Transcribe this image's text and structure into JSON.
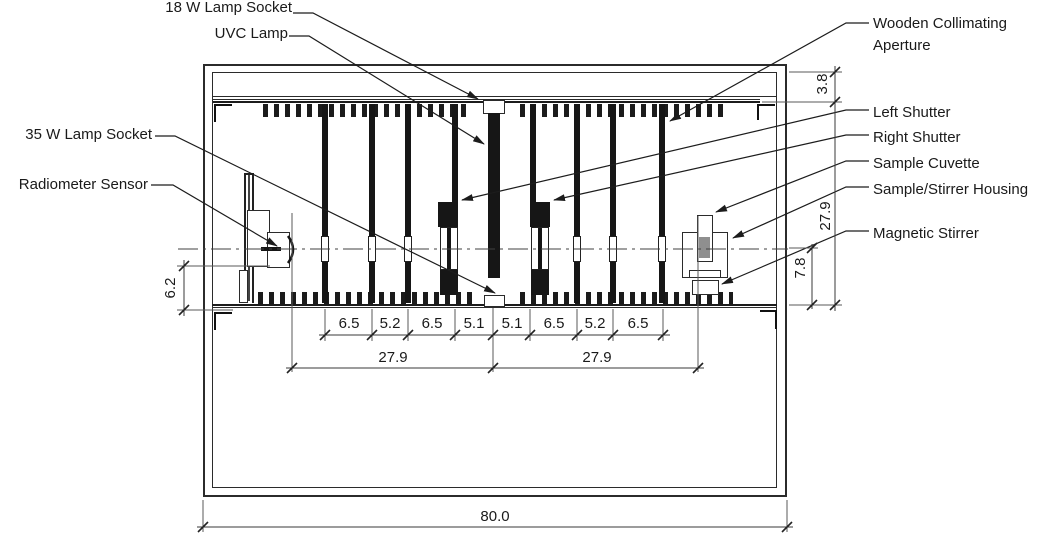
{
  "component_labels": {
    "lamp_socket_18w": "18 W Lamp Socket",
    "uvc_lamp": "UVC Lamp",
    "lamp_socket_35w": "35 W Lamp Socket",
    "radiometer_sensor": "Radiometer Sensor",
    "wooden_collimating_aperture_line1": "Wooden Collimating",
    "wooden_collimating_aperture_line2": "Aperture",
    "left_shutter": "Left Shutter",
    "right_shutter": "Right Shutter",
    "sample_cuvette": "Sample Cuvette",
    "sample_stirrer_housing": "Sample/Stirrer Housing",
    "magnetic_stirrer": "Magnetic Stirrer"
  },
  "dimensions": {
    "top_panel_height": "3.8",
    "sensor_axis_height": "6.2",
    "chamber_inner_height": "27.9",
    "sample_axis_height": "7.8",
    "aperture_spacings": [
      "6.5",
      "5.2",
      "6.5",
      "5.1",
      "5.1",
      "6.5",
      "5.2",
      "6.5"
    ],
    "lamp_to_sensor_span": "27.9",
    "lamp_to_sample_span": "27.9",
    "total_width": "80.0"
  },
  "colors": {
    "line": "#2a2a2a",
    "solid_fill": "#161616",
    "cuvette_sample_fill": "#8f8f8f",
    "background": "#ffffff"
  }
}
